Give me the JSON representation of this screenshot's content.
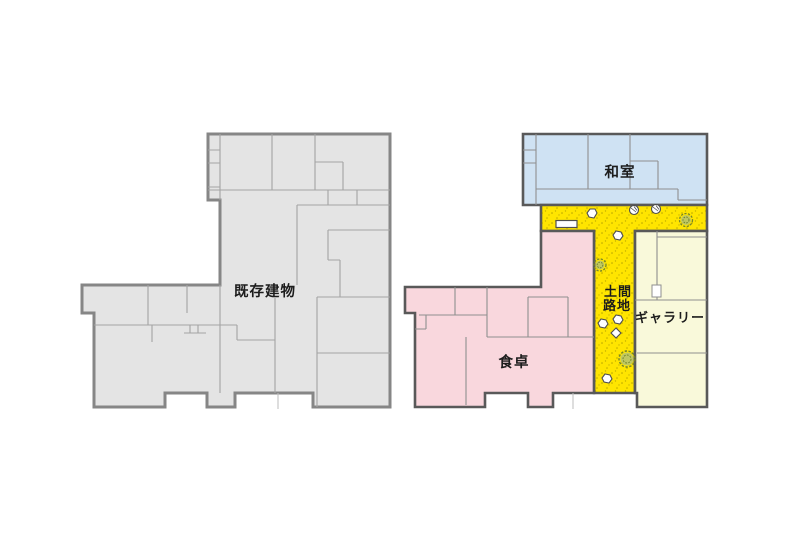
{
  "canvas": {
    "width": 800,
    "height": 541,
    "background": "#ffffff"
  },
  "text_color": "#1c1c1c",
  "plans": {
    "left": {
      "name": "existing building floor plan",
      "label": "既存建物",
      "fill": "#e4e4e4",
      "wall_color": "#868686",
      "line_color": "#a3a3a3"
    },
    "right": {
      "name": "renovated floor plan",
      "wall_color": "#595959",
      "line_color": "#8f8f8f",
      "rooms": {
        "washitsu": {
          "label": "和室",
          "fill": "#cfe2f3"
        },
        "doma": {
          "label": "土間路地",
          "line1": "土間",
          "line2": "路地",
          "fill": "#ffe500",
          "dot_color": "#7d6e00"
        },
        "gallery": {
          "label": "ギャラリー",
          "fill": "#f9f9da"
        },
        "dining": {
          "label": "食卓",
          "fill": "#f9d7dd"
        }
      },
      "garden": {
        "tree_fill": "#b9c46a",
        "tree_stroke": "#74842c",
        "stone_fill": "#ffffff",
        "stone_stroke": "#4f4f4f",
        "object_glyphs": {
          "tree": "dashed scribble circle",
          "stone": "small white polygon",
          "planter": "small hatched circle",
          "bench": "white rectangle",
          "door": "white gap rectangle"
        }
      }
    }
  }
}
